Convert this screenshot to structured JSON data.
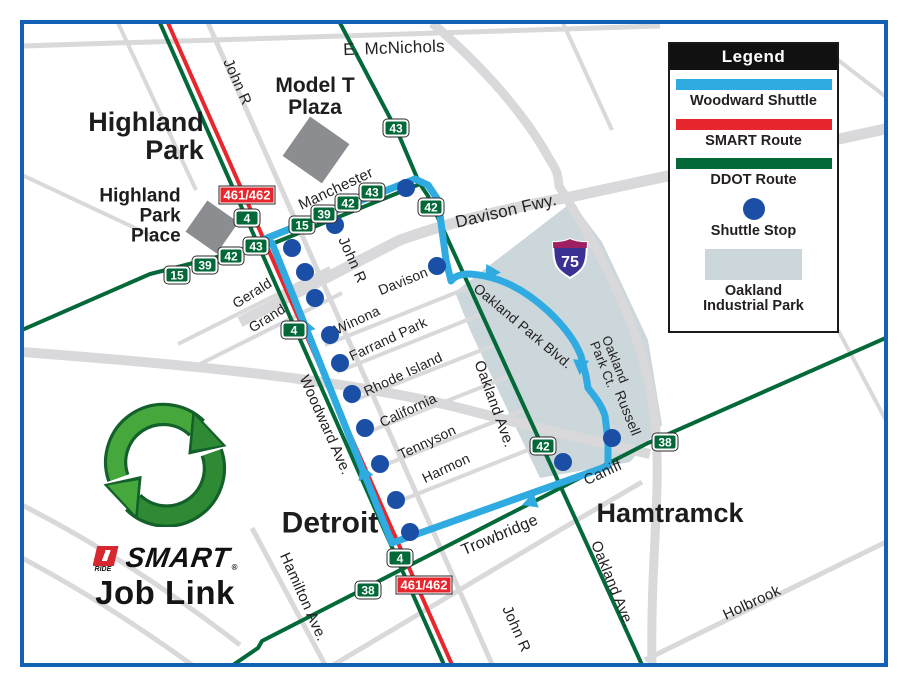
{
  "colors": {
    "shuttle_blue": "#2FABE1",
    "smart_red": "#E8262D",
    "ddot_green": "#046939",
    "stop_blue": "#1A4FA5",
    "industrial_park": "#CBD7DA",
    "border_blue": "#1261B5"
  },
  "legend": {
    "title": "Legend",
    "items": [
      {
        "type": "line",
        "color": "#2FABE1",
        "label": "Woodward Shuttle"
      },
      {
        "type": "line",
        "color": "#E8262D",
        "label": "SMART Route"
      },
      {
        "type": "line",
        "color": "#046939",
        "label": "DDOT Route"
      },
      {
        "type": "dot",
        "color": "#1A4FA5",
        "label": "Shuttle Stop"
      },
      {
        "type": "area",
        "color": "#CBD7DA",
        "label": "Oakland\nIndustrial Park"
      }
    ]
  },
  "logo": {
    "ride": "RIDE",
    "smart": "SMART",
    "registered": "®",
    "job_link": "Job Link"
  },
  "map": {
    "shield_number": "75",
    "cities": [
      {
        "t": "Highland\nPark",
        "x": 146,
        "y": 136,
        "s": 27,
        "align": "right"
      },
      {
        "t": "Model T\nPlaza",
        "x": 315,
        "y": 97,
        "s": 21,
        "align": "center"
      },
      {
        "t": "Highland\nPark\nPlace",
        "x": 140,
        "y": 216,
        "s": 19,
        "align": "right"
      },
      {
        "t": "Detroit",
        "x": 330,
        "y": 523,
        "s": 30,
        "align": "center"
      },
      {
        "t": "Hamtramck",
        "x": 670,
        "y": 513,
        "s": 27,
        "align": "center"
      }
    ],
    "streets": [
      {
        "t": "E. McNichols",
        "x": 394,
        "y": 48,
        "r": -2,
        "s": 17
      },
      {
        "t": "John R",
        "x": 237,
        "y": 82,
        "r": 66,
        "s": 15
      },
      {
        "t": "Manchester",
        "x": 336,
        "y": 189,
        "r": -25,
        "s": 15
      },
      {
        "t": "Davison Fwy.",
        "x": 506,
        "y": 211,
        "r": -13,
        "s": 17
      },
      {
        "t": "Davison",
        "x": 403,
        "y": 281,
        "r": -22,
        "s": 14
      },
      {
        "t": "John R",
        "x": 352,
        "y": 260,
        "r": 66,
        "s": 15
      },
      {
        "t": "Gerald",
        "x": 252,
        "y": 293,
        "r": -32,
        "s": 14
      },
      {
        "t": "Grand",
        "x": 267,
        "y": 318,
        "r": -32,
        "s": 14
      },
      {
        "t": "Winona",
        "x": 357,
        "y": 320,
        "r": -25,
        "s": 14
      },
      {
        "t": "Farrand Park",
        "x": 388,
        "y": 339,
        "r": -25,
        "s": 14
      },
      {
        "t": "Rhode Island",
        "x": 403,
        "y": 374,
        "r": -25,
        "s": 14
      },
      {
        "t": "California",
        "x": 408,
        "y": 410,
        "r": -25,
        "s": 14
      },
      {
        "t": "Tennyson",
        "x": 427,
        "y": 442,
        "r": -25,
        "s": 14
      },
      {
        "t": "Harmon",
        "x": 446,
        "y": 468,
        "r": -25,
        "s": 14
      },
      {
        "t": "Woodward Ave.",
        "x": 325,
        "y": 425,
        "r": 66,
        "s": 15
      },
      {
        "t": "Oakland Ave.",
        "x": 494,
        "y": 404,
        "r": 70,
        "s": 15
      },
      {
        "t": "Oakland Park Blvd.",
        "x": 523,
        "y": 326,
        "r": 40,
        "s": 14
      },
      {
        "t": "Oakland\nPark Ct.",
        "x": 609,
        "y": 362,
        "r": 68,
        "s": 13
      },
      {
        "t": "Russell",
        "x": 628,
        "y": 413,
        "r": 68,
        "s": 14
      },
      {
        "t": "Trowbridge",
        "x": 500,
        "y": 536,
        "r": -23,
        "s": 16
      },
      {
        "t": "Caniff",
        "x": 603,
        "y": 473,
        "r": -25,
        "s": 15
      },
      {
        "t": "Hamilton Ave.",
        "x": 303,
        "y": 597,
        "r": 66,
        "s": 15
      },
      {
        "t": "John R",
        "x": 516,
        "y": 629,
        "r": 66,
        "s": 15
      },
      {
        "t": "Oakland Ave.",
        "x": 612,
        "y": 584,
        "r": 68,
        "s": 15
      },
      {
        "t": "Holbrook",
        "x": 752,
        "y": 603,
        "r": -25,
        "s": 15
      }
    ],
    "badges": [
      {
        "t": "43",
        "x": 396,
        "y": 128,
        "k": "ddot"
      },
      {
        "t": "15",
        "x": 302,
        "y": 225,
        "k": "ddot"
      },
      {
        "t": "39",
        "x": 324,
        "y": 214,
        "k": "ddot"
      },
      {
        "t": "42",
        "x": 348,
        "y": 203,
        "k": "ddot"
      },
      {
        "t": "43",
        "x": 372,
        "y": 192,
        "k": "ddot"
      },
      {
        "t": "15",
        "x": 177,
        "y": 275,
        "k": "ddot"
      },
      {
        "t": "39",
        "x": 205,
        "y": 265,
        "k": "ddot"
      },
      {
        "t": "42",
        "x": 231,
        "y": 256,
        "k": "ddot"
      },
      {
        "t": "43",
        "x": 256,
        "y": 246,
        "k": "ddot"
      },
      {
        "t": "4",
        "x": 247,
        "y": 218,
        "k": "ddot"
      },
      {
        "t": "42",
        "x": 431,
        "y": 207,
        "k": "ddot"
      },
      {
        "t": "4",
        "x": 294,
        "y": 330,
        "k": "ddot"
      },
      {
        "t": "42",
        "x": 543,
        "y": 446,
        "k": "ddot"
      },
      {
        "t": "38",
        "x": 665,
        "y": 442,
        "k": "ddot"
      },
      {
        "t": "4",
        "x": 400,
        "y": 558,
        "k": "ddot"
      },
      {
        "t": "38",
        "x": 368,
        "y": 590,
        "k": "ddot"
      },
      {
        "t": "461/462",
        "x": 247,
        "y": 195,
        "k": "smart"
      },
      {
        "t": "461/462",
        "x": 424,
        "y": 585,
        "k": "smart"
      }
    ],
    "stops": [
      [
        292,
        248
      ],
      [
        305,
        272
      ],
      [
        315,
        298
      ],
      [
        330,
        335
      ],
      [
        340,
        363
      ],
      [
        352,
        394
      ],
      [
        365,
        428
      ],
      [
        380,
        464
      ],
      [
        396,
        500
      ],
      [
        410,
        532
      ],
      [
        335,
        225
      ],
      [
        406,
        188
      ],
      [
        437,
        266
      ],
      [
        612,
        438
      ],
      [
        563,
        462
      ]
    ]
  }
}
